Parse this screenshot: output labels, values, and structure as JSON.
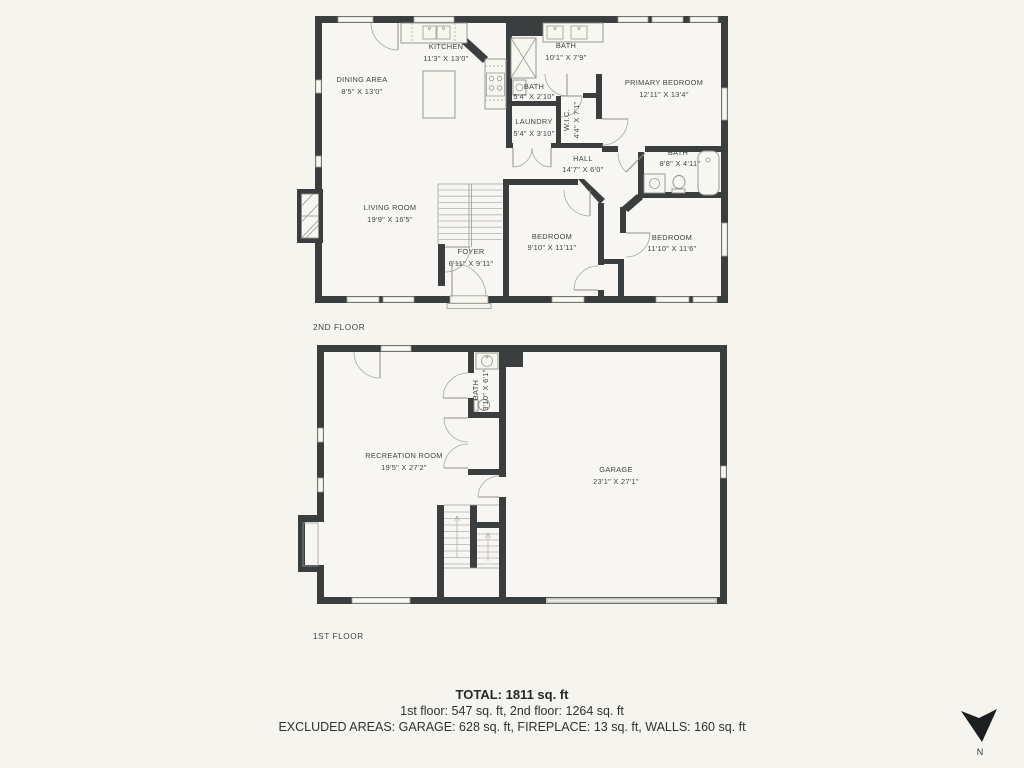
{
  "colors": {
    "background": "#f5f4ef",
    "wall": "#3a3e3e",
    "thin_line": "#9c9c96",
    "text": "#404545",
    "garage_door": "#c6c6c1"
  },
  "floor2": {
    "label": "2ND FLOOR",
    "rooms": {
      "dining": {
        "name": "DINING AREA",
        "dims": "8'5\" X 13'0\""
      },
      "kitchen": {
        "name": "KITCHEN",
        "dims": "11'3\" X 13'0\""
      },
      "bath_top": {
        "name": "BATH",
        "dims": "10'1\" X 7'9\""
      },
      "primary_bedroom": {
        "name": "PRIMARY BEDROOM",
        "dims": "12'11\" X 13'4\""
      },
      "bath_small": {
        "name": "BATH",
        "dims": "5'4\" X 2'10\""
      },
      "laundry": {
        "name": "LAUNDRY",
        "dims": "5'4\" X 3'10\""
      },
      "wic": {
        "name": "W.I.C.",
        "dims": "4'4\" X 7'1\""
      },
      "hall": {
        "name": "HALL",
        "dims": "14'7\" X 6'0\""
      },
      "bath_right": {
        "name": "BATH",
        "dims": "8'8\" X 4'11\""
      },
      "living": {
        "name": "LIVING ROOM",
        "dims": "19'9\" X 16'5\""
      },
      "foyer": {
        "name": "FOYER",
        "dims": "6'11\" X 9'11\""
      },
      "bedroom_mid": {
        "name": "BEDROOM",
        "dims": "9'10\" X 11'11\""
      },
      "bedroom_right": {
        "name": "BEDROOM",
        "dims": "11'10\" X 11'6\""
      }
    }
  },
  "floor1": {
    "label": "1ST FLOOR",
    "rooms": {
      "recreation": {
        "name": "RECREATION ROOM",
        "dims": "19'5\" X 27'2\""
      },
      "bath": {
        "name": "BATH",
        "dims": "3'10\" X 6'1\""
      },
      "garage": {
        "name": "GARAGE",
        "dims": "23'1\" X 27'1\""
      }
    }
  },
  "summary": {
    "total": "TOTAL: 1811 sq. ft",
    "floors": "1st floor: 547 sq. ft, 2nd floor: 1264 sq. ft",
    "excluded": "EXCLUDED AREAS: GARAGE: 628 sq. ft, FIREPLACE: 13 sq. ft, WALLS: 160 sq. ft"
  },
  "compass": {
    "label": "N"
  }
}
